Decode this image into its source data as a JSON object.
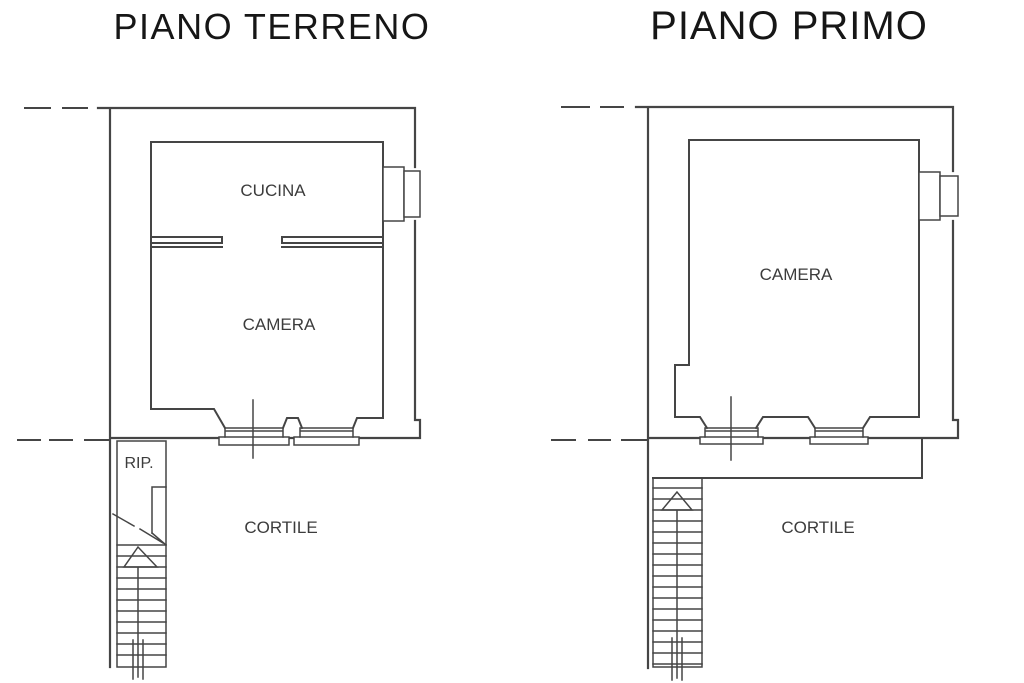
{
  "colors": {
    "line": "#454545",
    "text_title": "#161616",
    "text_label": "#3c3c3c",
    "background": "#ffffff"
  },
  "left_plan": {
    "title": "PIANO TERRENO",
    "rooms": {
      "cucina": "CUCINA",
      "camera": "CAMERA",
      "rip": "RIP.",
      "cortile": "CORTILE"
    }
  },
  "right_plan": {
    "title": "PIANO PRIMO",
    "rooms": {
      "camera": "CAMERA",
      "cortile": "CORTILE"
    }
  }
}
